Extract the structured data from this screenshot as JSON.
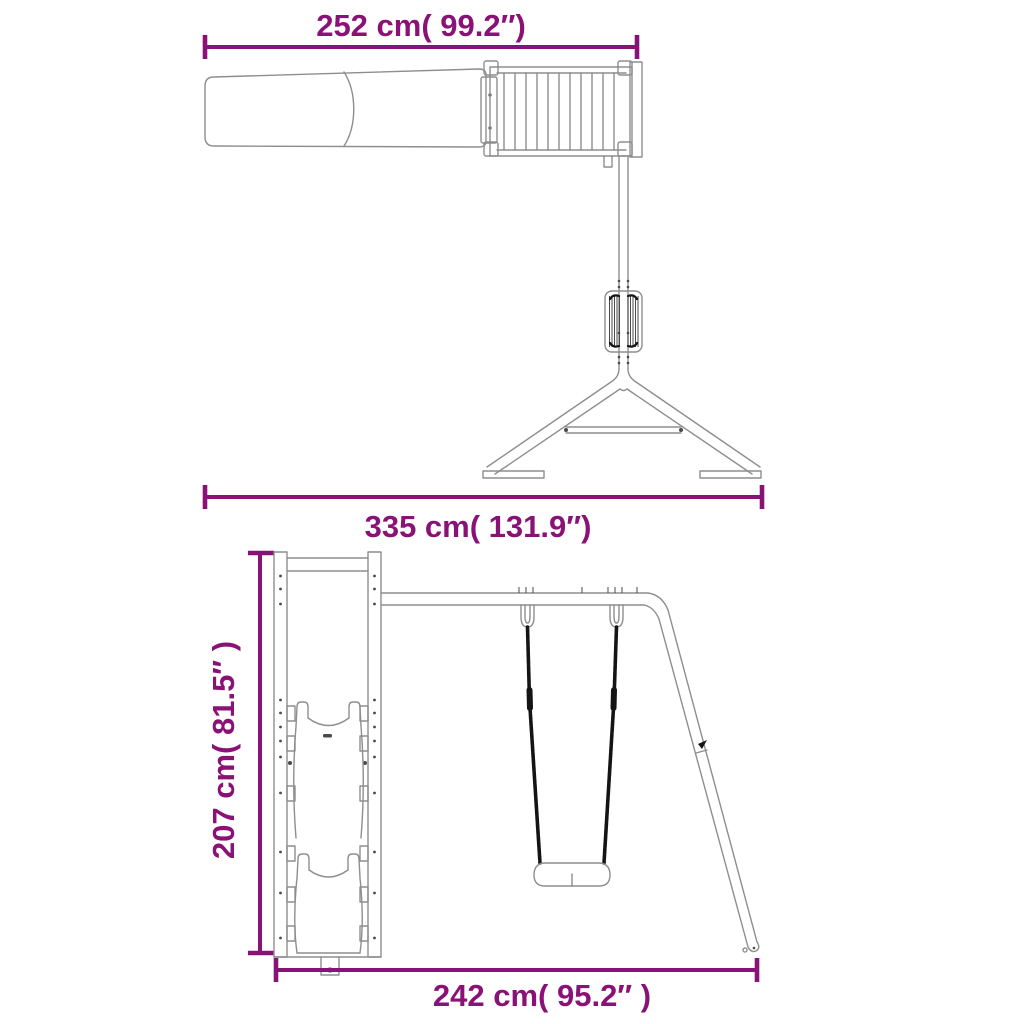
{
  "colors": {
    "accent": "#8A1277",
    "line": "#8e8e8e",
    "detail": "#4a4a4a",
    "rope": "#141414",
    "background": "#ffffff"
  },
  "dimensions": {
    "top_view_slide_width": "252 cm( 99.2″)",
    "top_view_total_width": "335 cm( 131.9″)",
    "front_view_height": "207 cm( 81.5″ )",
    "front_view_base_width": "242 cm( 95.2″ )"
  }
}
